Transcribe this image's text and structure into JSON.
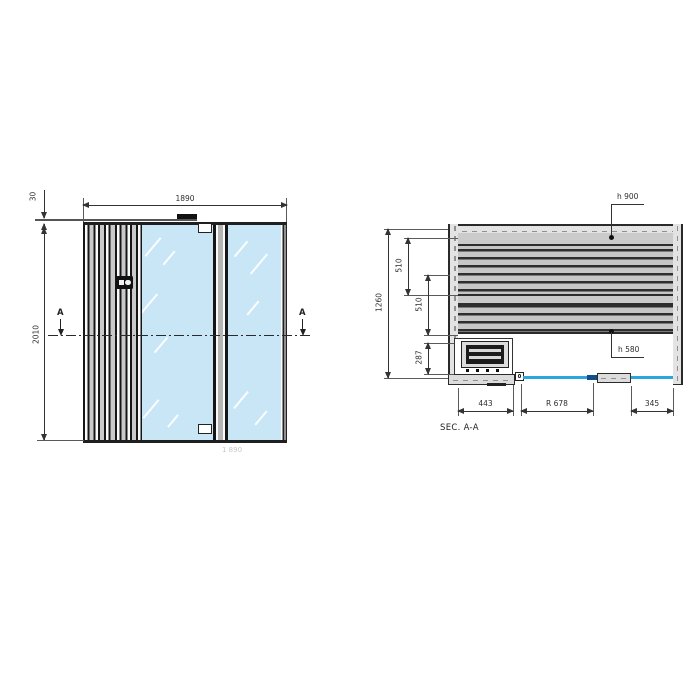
{
  "drawing": {
    "front_view": {
      "dim_width": "1890",
      "dim_height": "2010",
      "dim_roof_thickness": "30",
      "section_marker_left": "A",
      "section_marker_right": "A",
      "faint_bottom_dim": "1 890"
    },
    "section_view": {
      "caption": "SEC. A-A",
      "dim_depth": "1260",
      "dim_upper_bench": "510",
      "dim_lower_bench": "510",
      "dim_heater_zone": "287",
      "dim_front_left": "443",
      "dim_door_radius": "R 678",
      "dim_front_right": "345",
      "label_high_bench": "h 900",
      "label_low_bench": "h 580"
    },
    "colors": {
      "glass": "#c8e6f6",
      "glass_edge_line": "#2aa7e0",
      "door_handle": "#114f8b",
      "line": "#333333",
      "wall_fill": "#e3e3e3",
      "bench_board": "#c6c6c6"
    }
  }
}
